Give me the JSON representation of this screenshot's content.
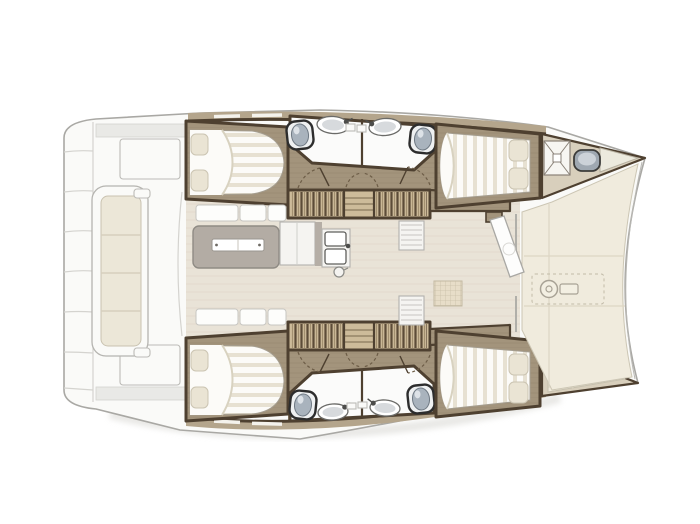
{
  "meta": {
    "title": "Catamaran yacht interior layout plan, top view, bow to the right",
    "type": "floor-plan-illustration",
    "canvas": {
      "width": 700,
      "height": 524
    },
    "text_visible": "none"
  },
  "layout": {
    "orientation": "bow-right",
    "hulls": [
      "port-hull-top",
      "starboard-hull-bottom"
    ],
    "rooms_visible": [
      "aft-double-cabin-top",
      "aft-double-cabin-bottom",
      "forward-double-cabin-top",
      "forward-double-cabin-bottom",
      "bathroom-top-aft",
      "bathroom-top-forward",
      "bathroom-bottom-aft",
      "bathroom-bottom-forward",
      "salon-with-galley-island",
      "companionway-stairs-x2",
      "forepeak-hatch-locker-top",
      "forepeak-berth-bottom",
      "aft-cockpit-bench",
      "aft-swim-platform",
      "foredeck-with-windlass"
    ],
    "counts": {
      "cabins": 4,
      "bathrooms": 4,
      "toilets": 4,
      "sinks_bath": 4,
      "galley_basins": 2,
      "stair_flights": 4
    }
  },
  "colors": {
    "background": "#ffffff",
    "deck_white": "#fafaf8",
    "deck_outline": "#a9a8a4",
    "deck_line": "#d4d3cf",
    "deck_shadow": "#e9e9e6",
    "hull_band": "#b4a58c",
    "wall_dark": "#4e4030",
    "wood_floor": "#a3947c",
    "wood_grain": "#8f8069",
    "bed_white": "#fcfbf8",
    "bed_stripe": "#e7e1d2",
    "pillow": "#eae4d4",
    "bath_white": "#fbfbfa",
    "toilet_ring": "#2d2d2d",
    "toilet_lid": "#a9b3bd",
    "stair_light": "#c9b796",
    "stair_dark": "#5c4c38",
    "salon_floor": "#e9e3d7",
    "salon_grain": "#e0d9c9",
    "island_gray": "#b3aca4",
    "cushion_cream": "#ece7d8",
    "foredeck_cream": "#f0ebdd",
    "foredeck_seam": "#ddd6c4",
    "forepeak_floor": "#d8cfbc",
    "metal_gray": "#9fa8b1",
    "metal_light": "#ccd2d8"
  }
}
